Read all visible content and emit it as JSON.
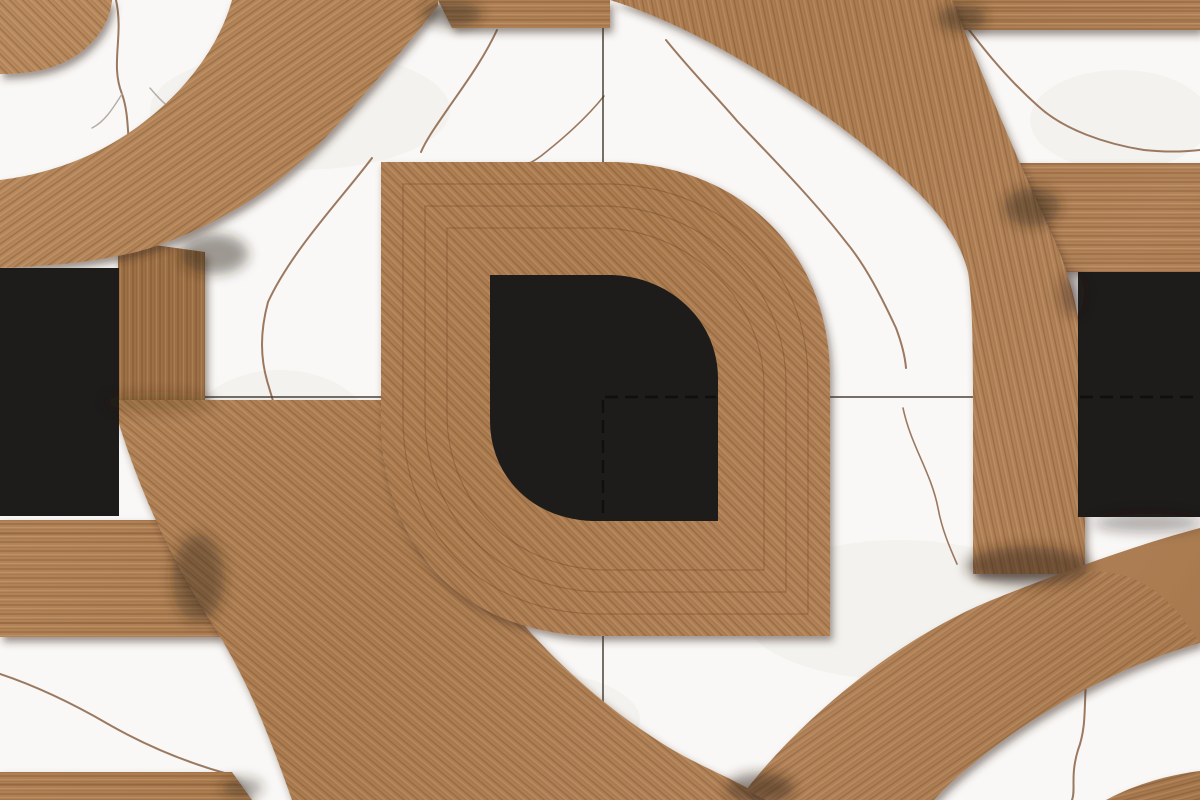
{
  "meta": {
    "title": "Wood and marble parquet tile pattern",
    "type": "decorative-tile-pattern",
    "description": "Digital mockup of a 2x2 laid ceramic tile pattern: wood-look rings, a central leaf (drop) motif with a black leaf core, black squares and wood bars over a white Calacatta-style marble background with brown veins. Thin grout joint lines cross at the center, rendered dashed where they pass over the black core.",
    "canvas": {
      "width": 1200,
      "height": 800
    },
    "aria_label": "Decorative floor tile pattern combining wood-texture rings and leaf shapes, black squares and white marble with brown veins"
  },
  "palette": {
    "marble_base": "#f9f8f6",
    "marble_mottle": "#efece8",
    "vein_brown": "#8b6347",
    "vein_gray": "#a8a097",
    "wood_light": "#c79f72",
    "wood_mid": "#b28258",
    "wood_base": "#aa7a4e",
    "wood_streak": "#5c3a1e",
    "wood_highlight": "#ffe4c4",
    "junction_shadow": "#2f2113",
    "black_inlay": "#1e1c1a",
    "grout_line": "#3f362c"
  },
  "grout_joints": {
    "vertical_x": 603,
    "horizontal_y": 397,
    "style_solid": "solid",
    "style_over_black": "dashed",
    "dashed_segments": [
      {
        "axis": "vertical",
        "from": 400,
        "to": 518
      },
      {
        "axis": "horizontal",
        "from": 605,
        "to": 716
      },
      {
        "axis": "horizontal",
        "from": 1080,
        "to": 1200
      }
    ]
  },
  "motifs": [
    {
      "id": "corner-disc-top-left",
      "kind": "wood-quarter-disc",
      "approx_bbox": [
        0,
        0,
        112,
        74
      ]
    },
    {
      "id": "ring-top-left",
      "kind": "wood-ring-band",
      "approx_bbox": [
        0,
        0,
        438,
        268
      ]
    },
    {
      "id": "connector-band-left",
      "kind": "wood-vertical-band",
      "approx_bbox": [
        118,
        240,
        205,
        400
      ]
    },
    {
      "id": "ring-top-right",
      "kind": "wood-ring-band",
      "approx_bbox": [
        610,
        0,
        1085,
        574
      ]
    },
    {
      "id": "ring-bottom-left",
      "kind": "wood-ring-band",
      "approx_bbox": [
        112,
        400,
        766,
        800
      ]
    },
    {
      "id": "ring-bottom-right",
      "kind": "wood-ring-band",
      "approx_bbox": [
        746,
        528,
        1200,
        800
      ]
    },
    {
      "id": "corner-wedge-bottom-right",
      "kind": "wood-quarter-disc",
      "approx_bbox": [
        1106,
        771,
        1200,
        800
      ]
    },
    {
      "id": "leaf-center",
      "kind": "wood-leaf-drop",
      "approx_bbox": [
        381,
        162,
        830,
        636
      ],
      "sharp_corners": [
        "top-left",
        "bottom-right"
      ],
      "rounded_corners": [
        "top-right",
        "bottom-left"
      ]
    },
    {
      "id": "leaf-core-black",
      "kind": "black-leaf-drop",
      "approx_bbox": [
        490,
        275,
        718,
        521
      ]
    },
    {
      "id": "black-square-left",
      "kind": "black-inlay",
      "approx_bbox": [
        0,
        268,
        119,
        516
      ]
    },
    {
      "id": "black-square-right",
      "kind": "black-inlay",
      "approx_bbox": [
        1078,
        272,
        1200,
        517
      ]
    },
    {
      "id": "bar-top-center",
      "kind": "wood-bar",
      "approx_bbox": [
        438,
        0,
        610,
        28
      ]
    },
    {
      "id": "bar-top-right",
      "kind": "wood-bar",
      "approx_bbox": [
        950,
        0,
        1200,
        30
      ]
    },
    {
      "id": "bar-right",
      "kind": "wood-bar",
      "approx_bbox": [
        1012,
        163,
        1200,
        272
      ]
    },
    {
      "id": "bar-left",
      "kind": "wood-bar",
      "approx_bbox": [
        0,
        520,
        222,
        637
      ]
    },
    {
      "id": "bar-bottom-left",
      "kind": "wood-bar",
      "approx_bbox": [
        0,
        772,
        252,
        800
      ]
    }
  ],
  "marble_veins": {
    "count": 12,
    "color": "#8b6347",
    "style": "thin jagged diagonal cracks"
  }
}
